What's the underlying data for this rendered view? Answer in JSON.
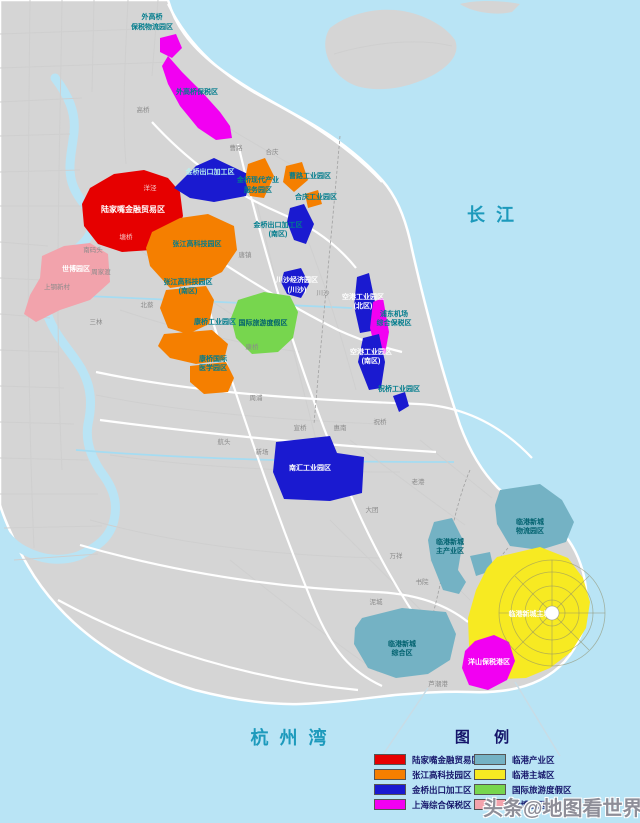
{
  "palette": {
    "red": "#e60000",
    "orange": "#f57f00",
    "blue": "#1a1ad0",
    "magenta": "#f200f2",
    "teal": "#74b2c4",
    "yellow": "#f7ea22",
    "green": "#77d64e",
    "pink": "#f2a3ac"
  },
  "water_labels": {
    "yangtze": "长 江",
    "hangzhou_bay": "杭 州 湾"
  },
  "zones": {
    "wgq_logistics_l1": "外高桥",
    "wgq_logistics_l2": "保税物流园区",
    "wgq_ftz": "外高桥保税区",
    "lujiazui": "陆家嘴金融贸易区",
    "jinqiao_n": "金桥出口加工区",
    "jq_modern_l1": "金桥现代产业",
    "jq_modern_l2": "服务园区",
    "caolu_park": "曹路工业园区",
    "heqing_park": "合庆工业园区",
    "jinqiao_s_l1": "金桥出口加工区",
    "jinqiao_s_l2": "(南区)",
    "zhangjiang": "张江高科技园区",
    "zj_s_l1": "张江高科技园区",
    "zj_s_l2": "(南区)",
    "kangqiao": "康桥工业园区",
    "med_l1": "康桥国际",
    "med_l2": "医学园区",
    "resort": "国际旅游度假区",
    "chuansha_l1": "川沙经济园区",
    "chuansha_l2": "(川沙)",
    "airport_n_l1": "空港工业园区",
    "airport_n_l2": "(北区)",
    "pdia_l1": "浦东机场",
    "pdia_l2": "综合保税区",
    "airport_s_l1": "空港工业园区",
    "airport_s_l2": "(南区)",
    "zhuqiao_park": "祝桥工业园区",
    "nanhui": "南汇工业园区",
    "lg_logistics_l1": "临港新城",
    "lg_logistics_l2": "物流园区",
    "lg_main_l1": "临港新城",
    "lg_main_l2": "主产业区",
    "lg_comp_l1": "临港新城",
    "lg_comp_l2": "综合区",
    "lg_city": "临港新城主城区",
    "yangshan": "洋山保税港区",
    "expo": "世博园区"
  },
  "towns": {
    "gaoqiao": "高桥",
    "caolu": "曹路",
    "heqing": "合庆",
    "tangzhen": "唐镇",
    "chuansha": "川沙",
    "beicai": "北蔡",
    "sanlin": "三林",
    "shangang": "上钢新村",
    "zhoujiadu": "周家渡",
    "nanmatou": "南码头",
    "yangjing": "洋泾",
    "tangqiao": "塘桥",
    "zhoupu": "周浦",
    "kangqiao_town": "康桥",
    "hangtou": "航头",
    "xinchang": "新场",
    "xuanqiao": "宣桥",
    "datuan": "大团",
    "huinan": "惠南",
    "laogang": "老港",
    "zhuqiao_town": "祝桥",
    "shuyuan": "书院",
    "wanxiang": "万祥",
    "nicheng": "泥城",
    "luchaogang": "芦潮港"
  },
  "legend": {
    "title": "图 例",
    "items": [
      {
        "label": "陆家嘴金融贸易区",
        "color": "#e60000"
      },
      {
        "label": "张江高科技园区",
        "color": "#f57f00"
      },
      {
        "label": "金桥出口加工区",
        "color": "#1a1ad0"
      },
      {
        "label": "上海综合保税区",
        "color": "#f200f2"
      },
      {
        "label": "临港产业区",
        "color": "#74b2c4"
      },
      {
        "label": "临港主城区",
        "color": "#f7ea22"
      },
      {
        "label": "国际旅游度假区",
        "color": "#77d64e"
      },
      {
        "label": "世博园区",
        "color": "#f2a3ac"
      }
    ]
  },
  "watermark": "头条@地图看世界"
}
